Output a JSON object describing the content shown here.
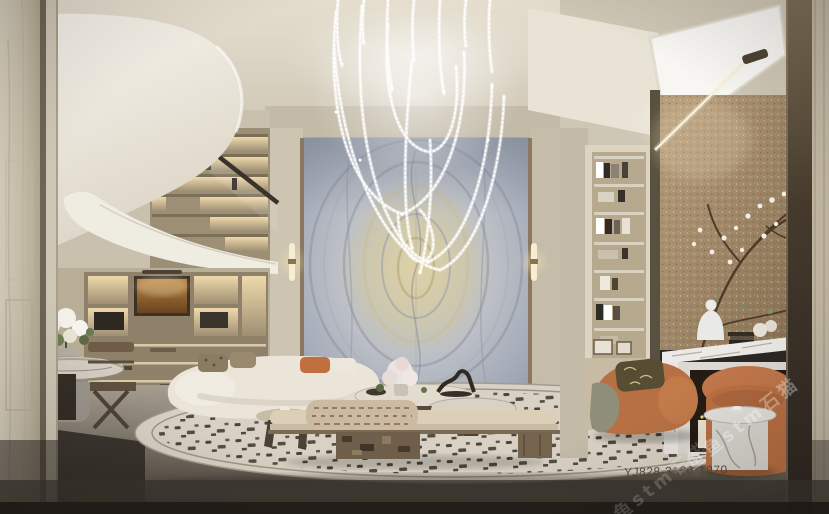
{
  "texts": {
    "product_code": "YJ828-3120*1970",
    "watermark_primary": "鱼鱼stm石猫",
    "watermark_secondary": "鱼鱼stm石猫"
  },
  "palette": {
    "ceiling_beige": "#ddd6c7",
    "wall_beige": "#c8bfac",
    "stair_white": "#f2efe7",
    "marble_blue_gray": "#b9bfc9",
    "marble_gold": "#d8cda0",
    "bronze_wall": "#a08a6c",
    "rust_accent": "#bd7245",
    "rug_cream": "#d9d2c4",
    "rug_speckle": "#332d26",
    "floor_gray": "#6f6a60",
    "pillar_dark": "#382f26",
    "pillar_light": "#cdc5b2",
    "crystal_white": "#ffffff",
    "sconce_glow": "#f4e2b8"
  }
}
